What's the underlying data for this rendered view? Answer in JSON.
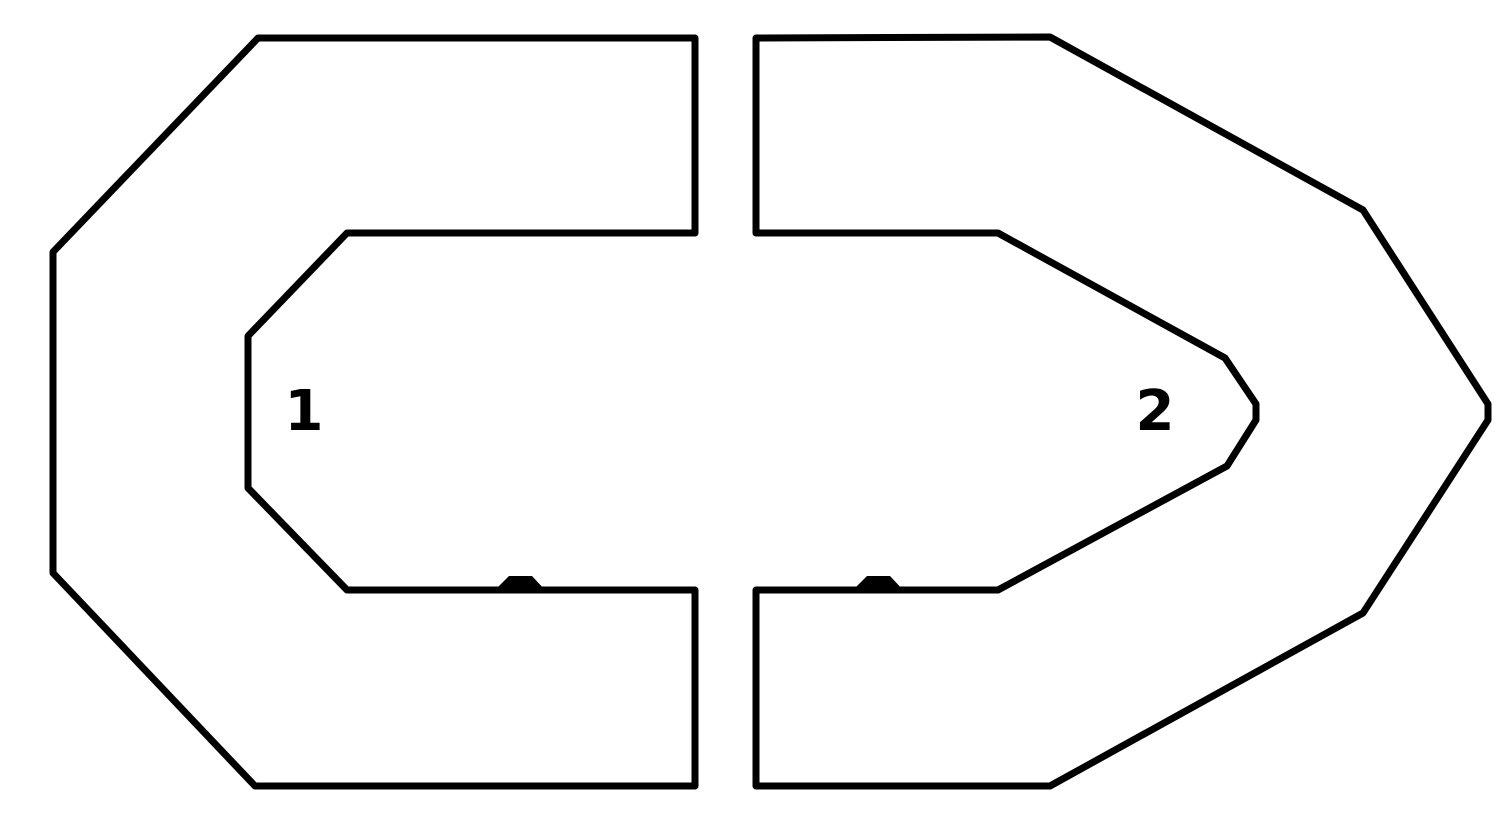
{
  "title": "Two-sector closed-loop track outline diagram",
  "colors": {
    "background": "#ffffff",
    "line": "#000000"
  },
  "stroke_width": 7,
  "sectors": [
    {
      "label": "1",
      "label_pos": {
        "x": 304,
        "y": 430
      },
      "outline_points": [
        [
          258,
          38
        ],
        [
          695,
          38
        ],
        [
          695,
          233
        ],
        [
          347,
          233
        ],
        [
          248,
          336
        ],
        [
          248,
          488
        ],
        [
          347,
          590
        ],
        [
          695,
          590
        ],
        [
          695,
          786
        ],
        [
          255,
          786
        ],
        [
          53,
          573
        ],
        [
          53,
          252
        ]
      ],
      "marker_points": [
        [
          494,
          591
        ],
        [
          509,
          576
        ],
        [
          532,
          576
        ],
        [
          546,
          591
        ]
      ]
    },
    {
      "label": "2",
      "label_pos": {
        "x": 1155,
        "y": 430
      },
      "outline_points": [
        [
          756,
          38
        ],
        [
          1050,
          37
        ],
        [
          1363,
          210
        ],
        [
          1488,
          404
        ],
        [
          1488,
          420
        ],
        [
          1363,
          613
        ],
        [
          1050,
          786
        ],
        [
          756,
          786
        ],
        [
          756,
          590
        ],
        [
          998,
          590
        ],
        [
          1227,
          466
        ],
        [
          1256,
          420
        ],
        [
          1256,
          404
        ],
        [
          1225,
          358
        ],
        [
          998,
          233
        ],
        [
          756,
          233
        ]
      ],
      "marker_points": [
        [
          852,
          591
        ],
        [
          867,
          576
        ],
        [
          890,
          576
        ],
        [
          904,
          591
        ]
      ]
    }
  ]
}
